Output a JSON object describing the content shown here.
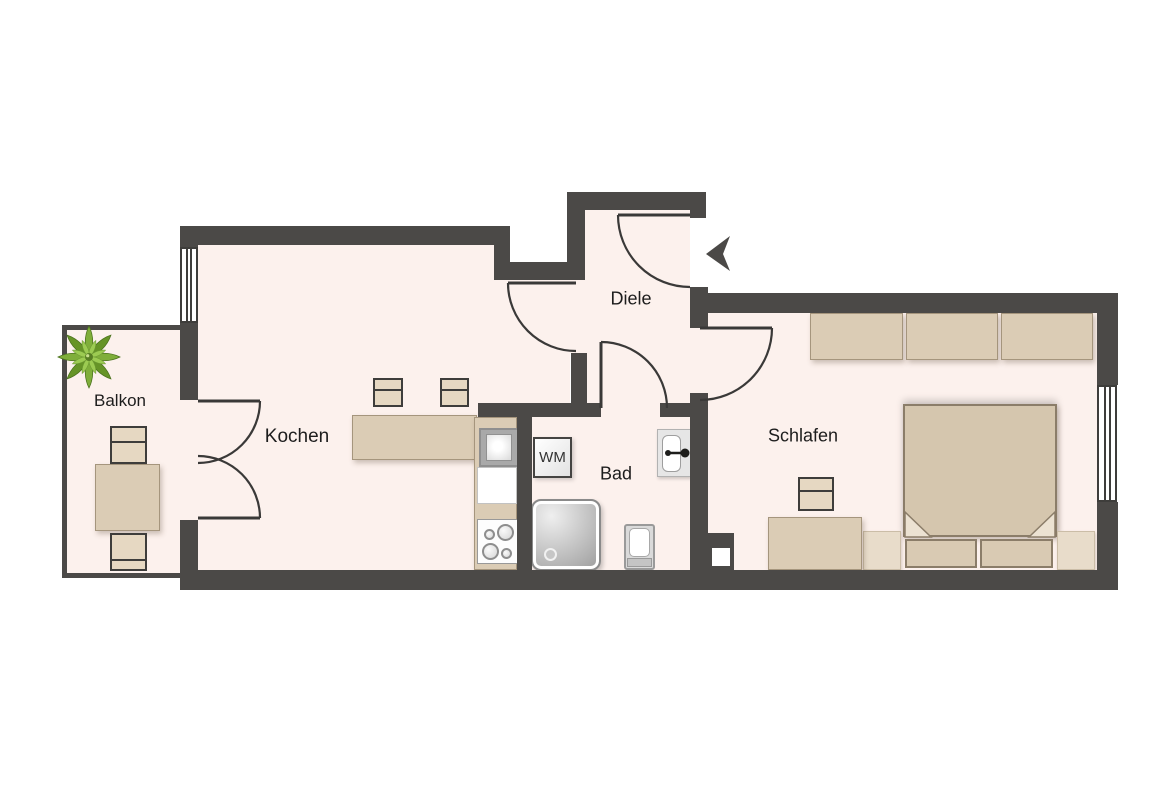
{
  "plan": {
    "colors": {
      "wall": "#4b4947",
      "floor": "#fcf1ed",
      "furniture_beige": "#dbccb5",
      "door_line": "#3a3938",
      "outside": "#ffffff",
      "plant_green": "#7fae3a"
    },
    "rooms": [
      {
        "id": "balkon",
        "label": "Balkon",
        "cx": 120,
        "cy": 401,
        "size": 17
      },
      {
        "id": "kochen",
        "label": "Kochen",
        "cx": 297,
        "cy": 437,
        "size": 19
      },
      {
        "id": "diele",
        "label": "Diele",
        "cx": 631,
        "cy": 299,
        "size": 18
      },
      {
        "id": "bad",
        "label": "Bad",
        "cx": 616,
        "cy": 474,
        "size": 18
      },
      {
        "id": "schlafen",
        "label": "Schlafen",
        "cx": 803,
        "cy": 436,
        "size": 18
      }
    ],
    "floors": [
      {
        "id": "kochen-a",
        "r": [
          198,
          245,
          312,
          327
        ]
      },
      {
        "id": "kochen-b",
        "r": [
          510,
          262,
          60,
          310
        ]
      },
      {
        "id": "kochen-door-gap",
        "r": [
          567,
          280,
          18,
          73
        ]
      },
      {
        "id": "diele",
        "r": [
          585,
          210,
          105,
          196
        ]
      },
      {
        "id": "schlafen-door-gap",
        "r": [
          690,
          328,
          18,
          65
        ]
      },
      {
        "id": "bad",
        "r": [
          532,
          417,
          158,
          155
        ]
      },
      {
        "id": "bad-door-gap",
        "r": [
          601,
          403,
          59,
          14
        ]
      },
      {
        "id": "schlafen",
        "r": [
          708,
          313,
          389,
          259
        ]
      },
      {
        "id": "balcony-door-gap",
        "r": [
          180,
          400,
          18,
          120
        ]
      },
      {
        "id": "balcony",
        "r": [
          67,
          330,
          113,
          243
        ]
      }
    ],
    "walls": [
      {
        "id": "kochen-top",
        "r": [
          180,
          226,
          330,
          19
        ]
      },
      {
        "id": "step-vertical",
        "r": [
          494,
          245,
          16,
          35
        ]
      },
      {
        "id": "mid-horizontal",
        "r": [
          494,
          262,
          91,
          18
        ]
      },
      {
        "id": "diele-left",
        "r": [
          567,
          192,
          18,
          88
        ]
      },
      {
        "id": "diele-top",
        "r": [
          567,
          192,
          139,
          18
        ]
      },
      {
        "id": "entrance-jamb",
        "r": [
          690,
          210,
          16,
          8
        ]
      },
      {
        "id": "entrance-stub",
        "r": [
          690,
          287,
          18,
          41
        ]
      },
      {
        "id": "kochen-stub",
        "r": [
          571,
          353,
          16,
          52
        ]
      },
      {
        "id": "bad-top-left",
        "r": [
          478,
          403,
          123,
          14
        ]
      },
      {
        "id": "bad-top-right",
        "r": [
          660,
          403,
          46,
          14
        ]
      },
      {
        "id": "kochen-bad-divider",
        "r": [
          517,
          415,
          15,
          157
        ]
      },
      {
        "id": "bad-schlafen",
        "r": [
          690,
          393,
          18,
          177
        ]
      },
      {
        "id": "shaft-block",
        "r": [
          700,
          533,
          34,
          37
        ]
      },
      {
        "id": "schlafen-top",
        "r": [
          706,
          293,
          412,
          20
        ]
      },
      {
        "id": "right-upper",
        "r": [
          1097,
          293,
          21,
          92
        ]
      },
      {
        "id": "right-lower",
        "r": [
          1097,
          502,
          21,
          88
        ]
      },
      {
        "id": "bottom",
        "r": [
          180,
          570,
          938,
          20
        ]
      },
      {
        "id": "left-a",
        "r": [
          180,
          226,
          18,
          22
        ]
      },
      {
        "id": "left-b",
        "r": [
          180,
          322,
          18,
          78
        ]
      },
      {
        "id": "left-c",
        "r": [
          180,
          520,
          18,
          52
        ]
      }
    ],
    "balcony_walls": [
      {
        "id": "balcony-left",
        "r": [
          62,
          325,
          5,
          253
        ]
      },
      {
        "id": "balcony-top",
        "r": [
          62,
          325,
          120,
          5
        ]
      },
      {
        "id": "balcony-bottom",
        "r": [
          62,
          573,
          120,
          5
        ]
      }
    ],
    "shaft_notch": {
      "id": "shaft-notch",
      "r": [
        712,
        548,
        18,
        18
      ]
    },
    "windows": [
      {
        "id": "kochen-window",
        "r": [
          180,
          247,
          18,
          76
        ]
      },
      {
        "id": "schlafen-window",
        "r": [
          1097,
          385,
          20,
          117
        ]
      }
    ],
    "door_leaves": [
      {
        "id": "balcony-door-top-leaf",
        "x1": 198,
        "y1": 401,
        "x2": 260,
        "y2": 401
      },
      {
        "id": "balcony-door-bottom-leaf",
        "x1": 198,
        "y1": 518,
        "x2": 260,
        "y2": 518
      },
      {
        "id": "kochen-door-leaf",
        "x1": 508,
        "y1": 283,
        "x2": 576,
        "y2": 283
      },
      {
        "id": "bad-door-leaf",
        "x1": 601,
        "y1": 342,
        "x2": 601,
        "y2": 408
      },
      {
        "id": "entrance-door-leaf",
        "x1": 618,
        "y1": 215,
        "x2": 690,
        "y2": 215
      },
      {
        "id": "schlafen-door-leaf",
        "x1": 700,
        "y1": 328,
        "x2": 772,
        "y2": 328
      }
    ],
    "door_arcs": [
      {
        "id": "balcony-door-top-arc",
        "d": "M260,401 A62,62 0 0 1 198,463"
      },
      {
        "id": "balcony-door-bottom-arc",
        "d": "M260,518 A62,62 0 0 0 198,456"
      },
      {
        "id": "kochen-door-arc",
        "d": "M508,283 A68,68 0 0 0 576,351"
      },
      {
        "id": "bad-door-arc",
        "d": "M601,342 A66,66 0 0 1 667,408"
      },
      {
        "id": "entrance-door-arc",
        "d": "M618,215 A72,72 0 0 0 690,287"
      },
      {
        "id": "schlafen-door-arc",
        "d": "M772,328 A72,72 0 0 1 700,400"
      }
    ],
    "entrance_arrow": {
      "points": "706,254 730,236 723,254 730,271"
    },
    "plant": {
      "cx": 89,
      "cy": 357
    },
    "bed_folds": [
      {
        "id": "bed-fold-left",
        "points": "905,537 905,512 931,537"
      },
      {
        "id": "bed-fold-right",
        "points": "1055,537 1055,512 1029,537"
      }
    ],
    "sink_faucet": {
      "x1": 668,
      "y1": 453,
      "x2": 685,
      "y2": 453,
      "dot_r": 4.5,
      "knob_r": 3
    },
    "furniture": [
      {
        "type": "beige",
        "name": "kitchen-counter",
        "r": [
          352,
          415,
          125,
          45
        ]
      },
      {
        "type": "beige",
        "name": "kitchen-counter-vertical",
        "r": [
          474,
          417,
          43,
          153
        ]
      },
      {
        "type": "appl",
        "name": "kitchen-sink-unit",
        "r": [
          479,
          428,
          40,
          39
        ]
      },
      {
        "type": "white",
        "name": "kitchen-cabinet",
        "r": [
          477,
          467,
          40,
          37
        ]
      },
      {
        "type": "stove",
        "name": "stove",
        "r": [
          477,
          519,
          41,
          45
        ],
        "burners": [
          [
            6,
            9,
            11
          ],
          [
            19,
            4,
            17
          ],
          [
            4,
            23,
            17
          ],
          [
            23,
            28,
            11
          ]
        ]
      },
      {
        "type": "stool",
        "name": "bar-stool-1",
        "r": [
          373,
          378,
          30,
          29
        ],
        "line": 9
      },
      {
        "type": "stool",
        "name": "bar-stool-2",
        "r": [
          440,
          378,
          29,
          29
        ],
        "line": 9
      },
      {
        "type": "wm",
        "name": "washing-machine",
        "r": [
          533,
          437,
          39,
          41
        ],
        "label": "WM"
      },
      {
        "type": "shower",
        "name": "shower",
        "r": [
          531,
          499,
          70,
          72
        ]
      },
      {
        "type": "toilet",
        "name": "toilet",
        "r": [
          624,
          524,
          31,
          46
        ]
      },
      {
        "type": "sink",
        "name": "bathroom-sink",
        "r": [
          657,
          429,
          34,
          48
        ]
      },
      {
        "type": "beige",
        "name": "wardrobe-section-1",
        "r": [
          810,
          313,
          93,
          47
        ]
      },
      {
        "type": "beige",
        "name": "wardrobe-section-2",
        "r": [
          906,
          313,
          92,
          47
        ]
      },
      {
        "type": "beige",
        "name": "wardrobe-section-3",
        "r": [
          1001,
          313,
          92,
          47
        ]
      },
      {
        "type": "duvet",
        "name": "double-bed",
        "r": [
          903,
          404,
          154,
          133
        ]
      },
      {
        "type": "pillow",
        "name": "pillow-left",
        "r": [
          905,
          539,
          72,
          29
        ]
      },
      {
        "type": "pillow",
        "name": "pillow-right",
        "r": [
          980,
          539,
          73,
          29
        ]
      },
      {
        "type": "beigelight",
        "name": "nightstand-left",
        "r": [
          863,
          531,
          38,
          39
        ]
      },
      {
        "type": "beigelight",
        "name": "nightstand-right",
        "r": [
          1057,
          531,
          38,
          39
        ]
      },
      {
        "type": "beige",
        "name": "dresser",
        "r": [
          768,
          517,
          94,
          53
        ]
      },
      {
        "type": "stool",
        "name": "bedroom-stool",
        "r": [
          798,
          477,
          36,
          34
        ],
        "line": 11
      },
      {
        "type": "beige",
        "name": "balcony-table",
        "r": [
          95,
          464,
          65,
          67
        ]
      },
      {
        "type": "stool",
        "name": "balcony-chair-top",
        "r": [
          110,
          426,
          37,
          38
        ],
        "line": 13
      },
      {
        "type": "stool",
        "name": "balcony-chair-bottom",
        "r": [
          110,
          533,
          37,
          38
        ],
        "line": 24
      }
    ]
  }
}
